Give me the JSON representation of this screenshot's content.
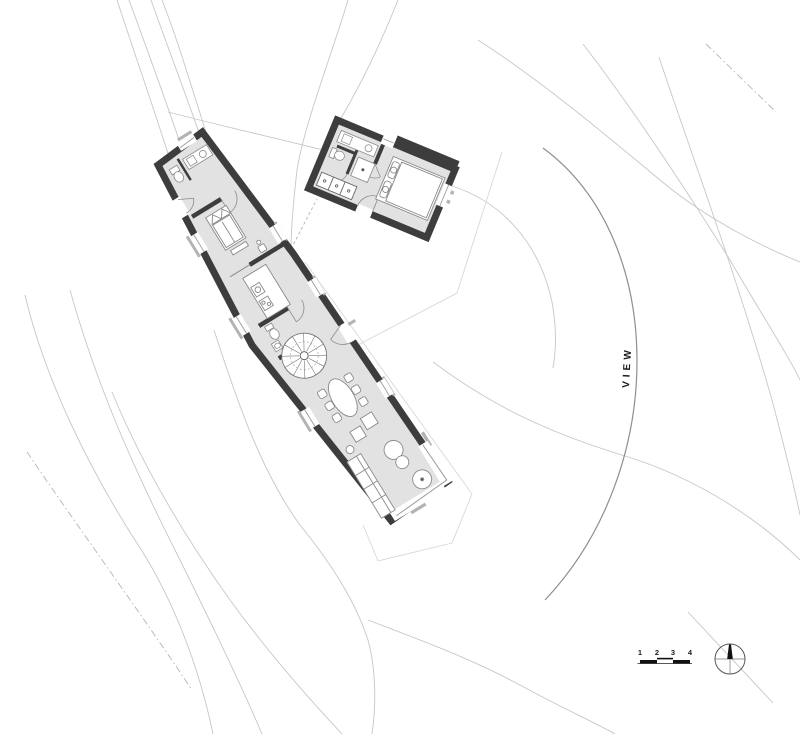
{
  "plan": {
    "view_label": "VIEW",
    "type": "architectural-site-plan",
    "buildings": {
      "main_house": "long rotated bar with bathroom, bedroom, kitchen, wc, spiral stair, dining and living areas",
      "guest_house": "small rotated rectangle with bathroom, wardrobe and bedroom"
    }
  },
  "scale_bar": {
    "labels": [
      "1",
      "2",
      "3",
      "4"
    ]
  },
  "colors": {
    "wall": "#3d3d3d",
    "floor": "#e2e2e2",
    "contour": "#c7c7c7",
    "faint_line": "#d8d8d8",
    "furniture_stroke": "#8a8a8a",
    "sill": "#b3b3b3",
    "arc": "#8f8f8f",
    "text": "#1a1a1a"
  }
}
